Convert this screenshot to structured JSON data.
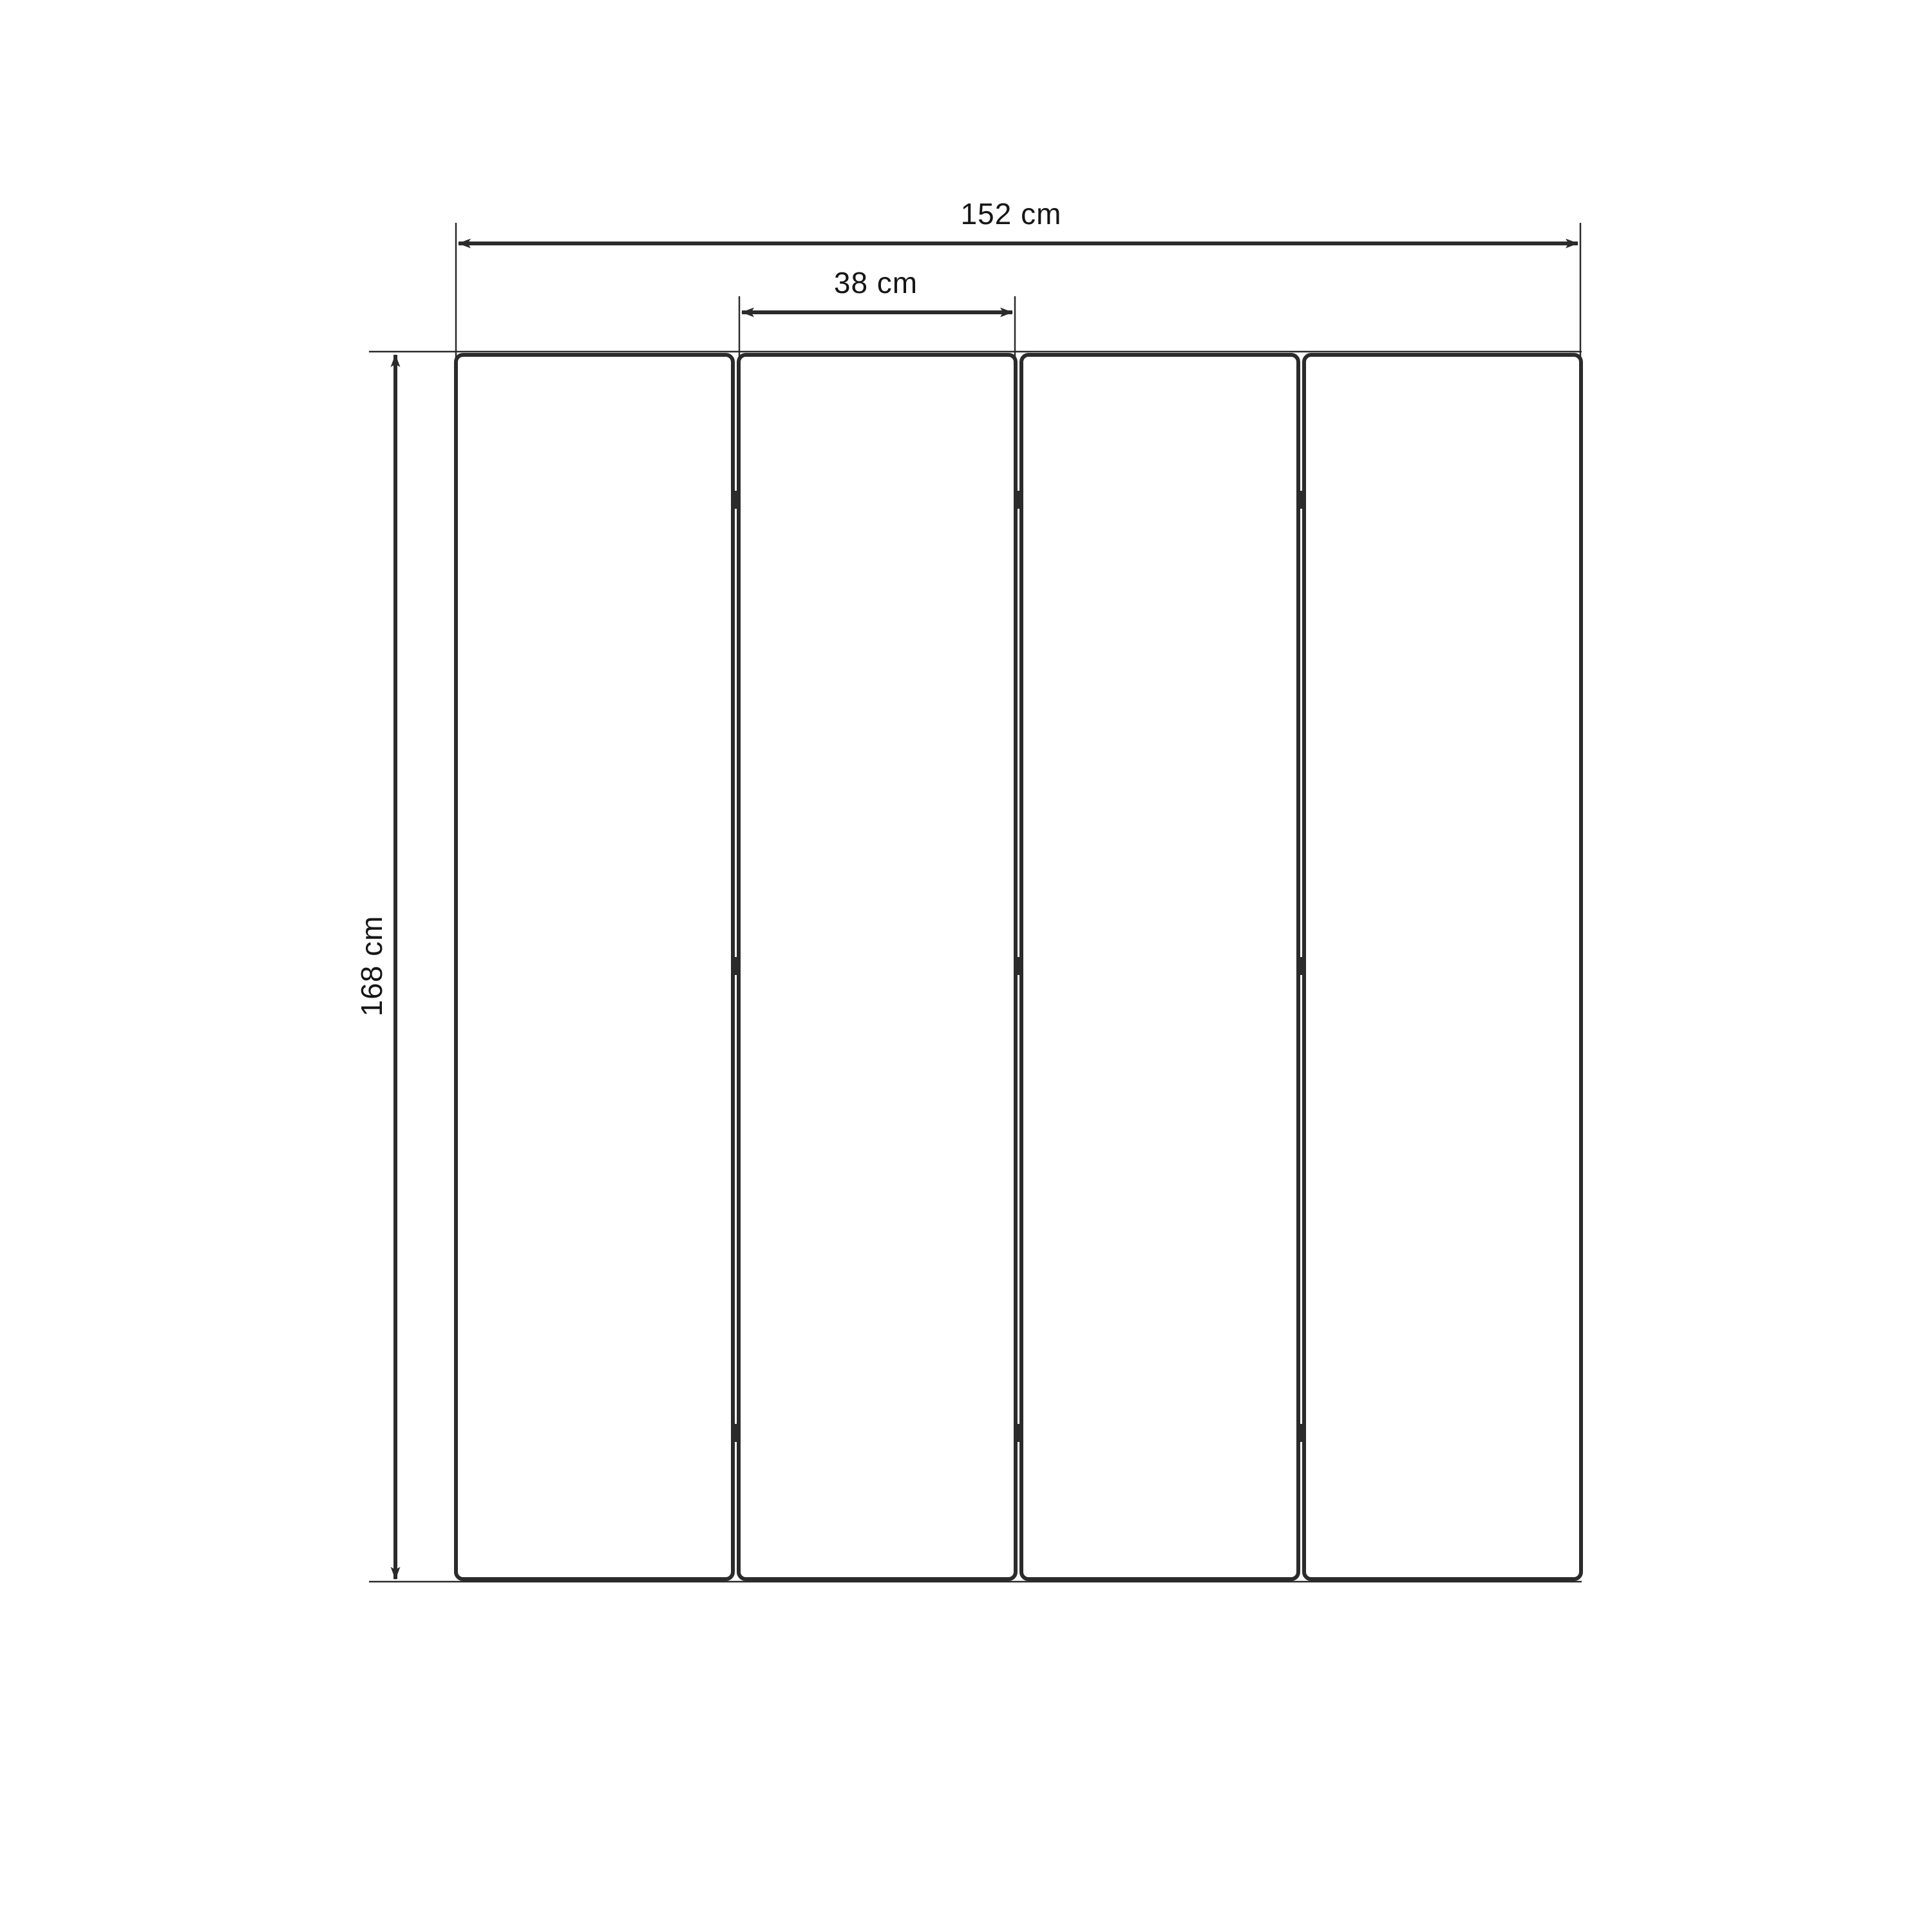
{
  "figure": {
    "type": "dimension-diagram",
    "subject": "four-panel folding screen front view",
    "panel_count": 4,
    "hinge_marks_per_gap": 3,
    "colors": {
      "background": "#ffffff",
      "line": "#2b2b2b",
      "text": "#161616"
    },
    "dimensions": {
      "total_width_label": "152 cm",
      "panel_width_label": "38 cm",
      "height_label": "168 cm"
    }
  }
}
